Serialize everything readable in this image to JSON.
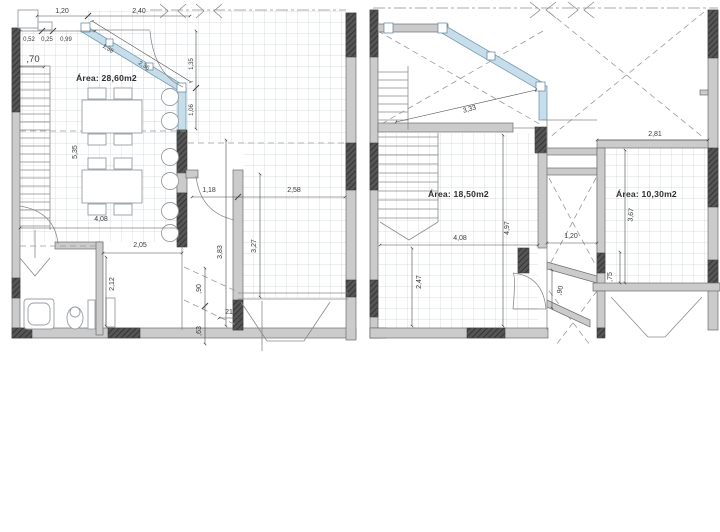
{
  "drawing": {
    "type": "architectural-floor-plans",
    "sheets": 2
  },
  "colors": {
    "glazing": "#c7dde9",
    "wall_light": "#cbcbcb",
    "wall_dark": "#4f4f4f",
    "grid_line": "#ccd3d7",
    "dim_text": "#3a3a3a"
  },
  "left_plan": {
    "area_label": "Área: 28,60m2",
    "dims": {
      "top_a": "1,20",
      "top_b": "2,40",
      "sub_a": "0,52",
      "sub_b": "0,25",
      "sub_c": "0,99",
      "left_top": ",70",
      "room_height": "5,35",
      "room_width": "4,08",
      "hall_width": "2,05",
      "bath_height": "2,12",
      "door": "1,18",
      "entry_width": "2,58",
      "entry_height": "3,27",
      "corridor_height": "3,83",
      "step_a": ",90",
      "step_b": ",63",
      "step_c": "21",
      "glass_a": "1,38",
      "glass_b": "2,36",
      "side_a": "1,35",
      "side_b": "1,06"
    }
  },
  "right_plan": {
    "room_a_area": "Área: 18,50m2",
    "room_b_area": "Área: 10,30m2",
    "dims": {
      "glass": "3,33",
      "room_b_width": "2,81",
      "room_a_width": "4,08",
      "room_a_height": "4,97",
      "lower_height": "2,47",
      "shaft_width": "1,20",
      "door": ",90",
      "wall": ",75",
      "room_b_height": "3,67"
    }
  }
}
